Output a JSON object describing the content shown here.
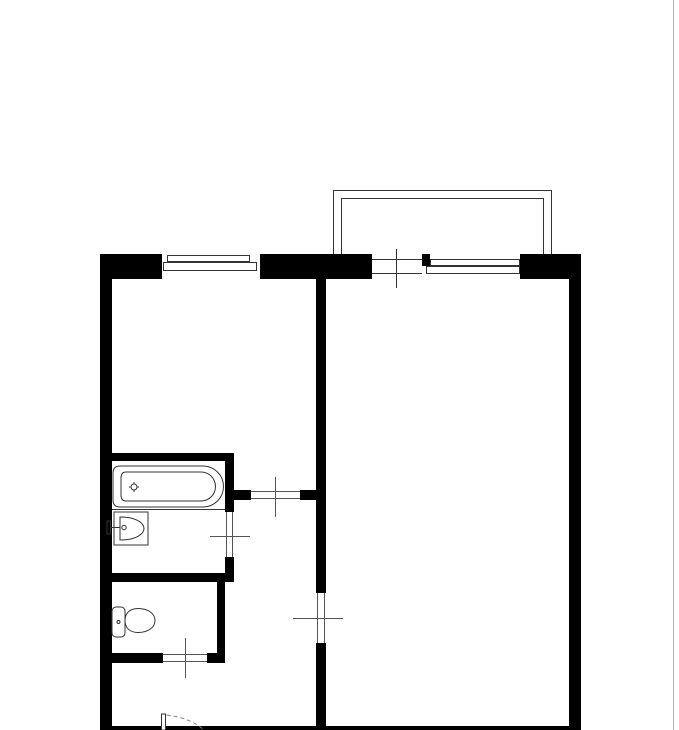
{
  "drawing": {
    "kind": "apartment-floor-plan",
    "colors": {
      "wall": "#000000",
      "bg": "#ffffff",
      "thin": "#333333",
      "mark": "#555555",
      "fixture": "#333333",
      "swing": "#808080",
      "pgborder": "#b3b3b3"
    },
    "fixtures": [
      "bathtub",
      "sink",
      "toilet",
      "entrance-door-swing"
    ],
    "openings": [
      "left-window",
      "balcony-door",
      "balcony-window",
      "hall-room-door",
      "bathroom-door",
      "big-room-door",
      "toilet-door",
      "entrance-door"
    ],
    "areas": [
      "room-left",
      "room-right",
      "bathroom",
      "toilet",
      "hallway",
      "balcony"
    ]
  }
}
